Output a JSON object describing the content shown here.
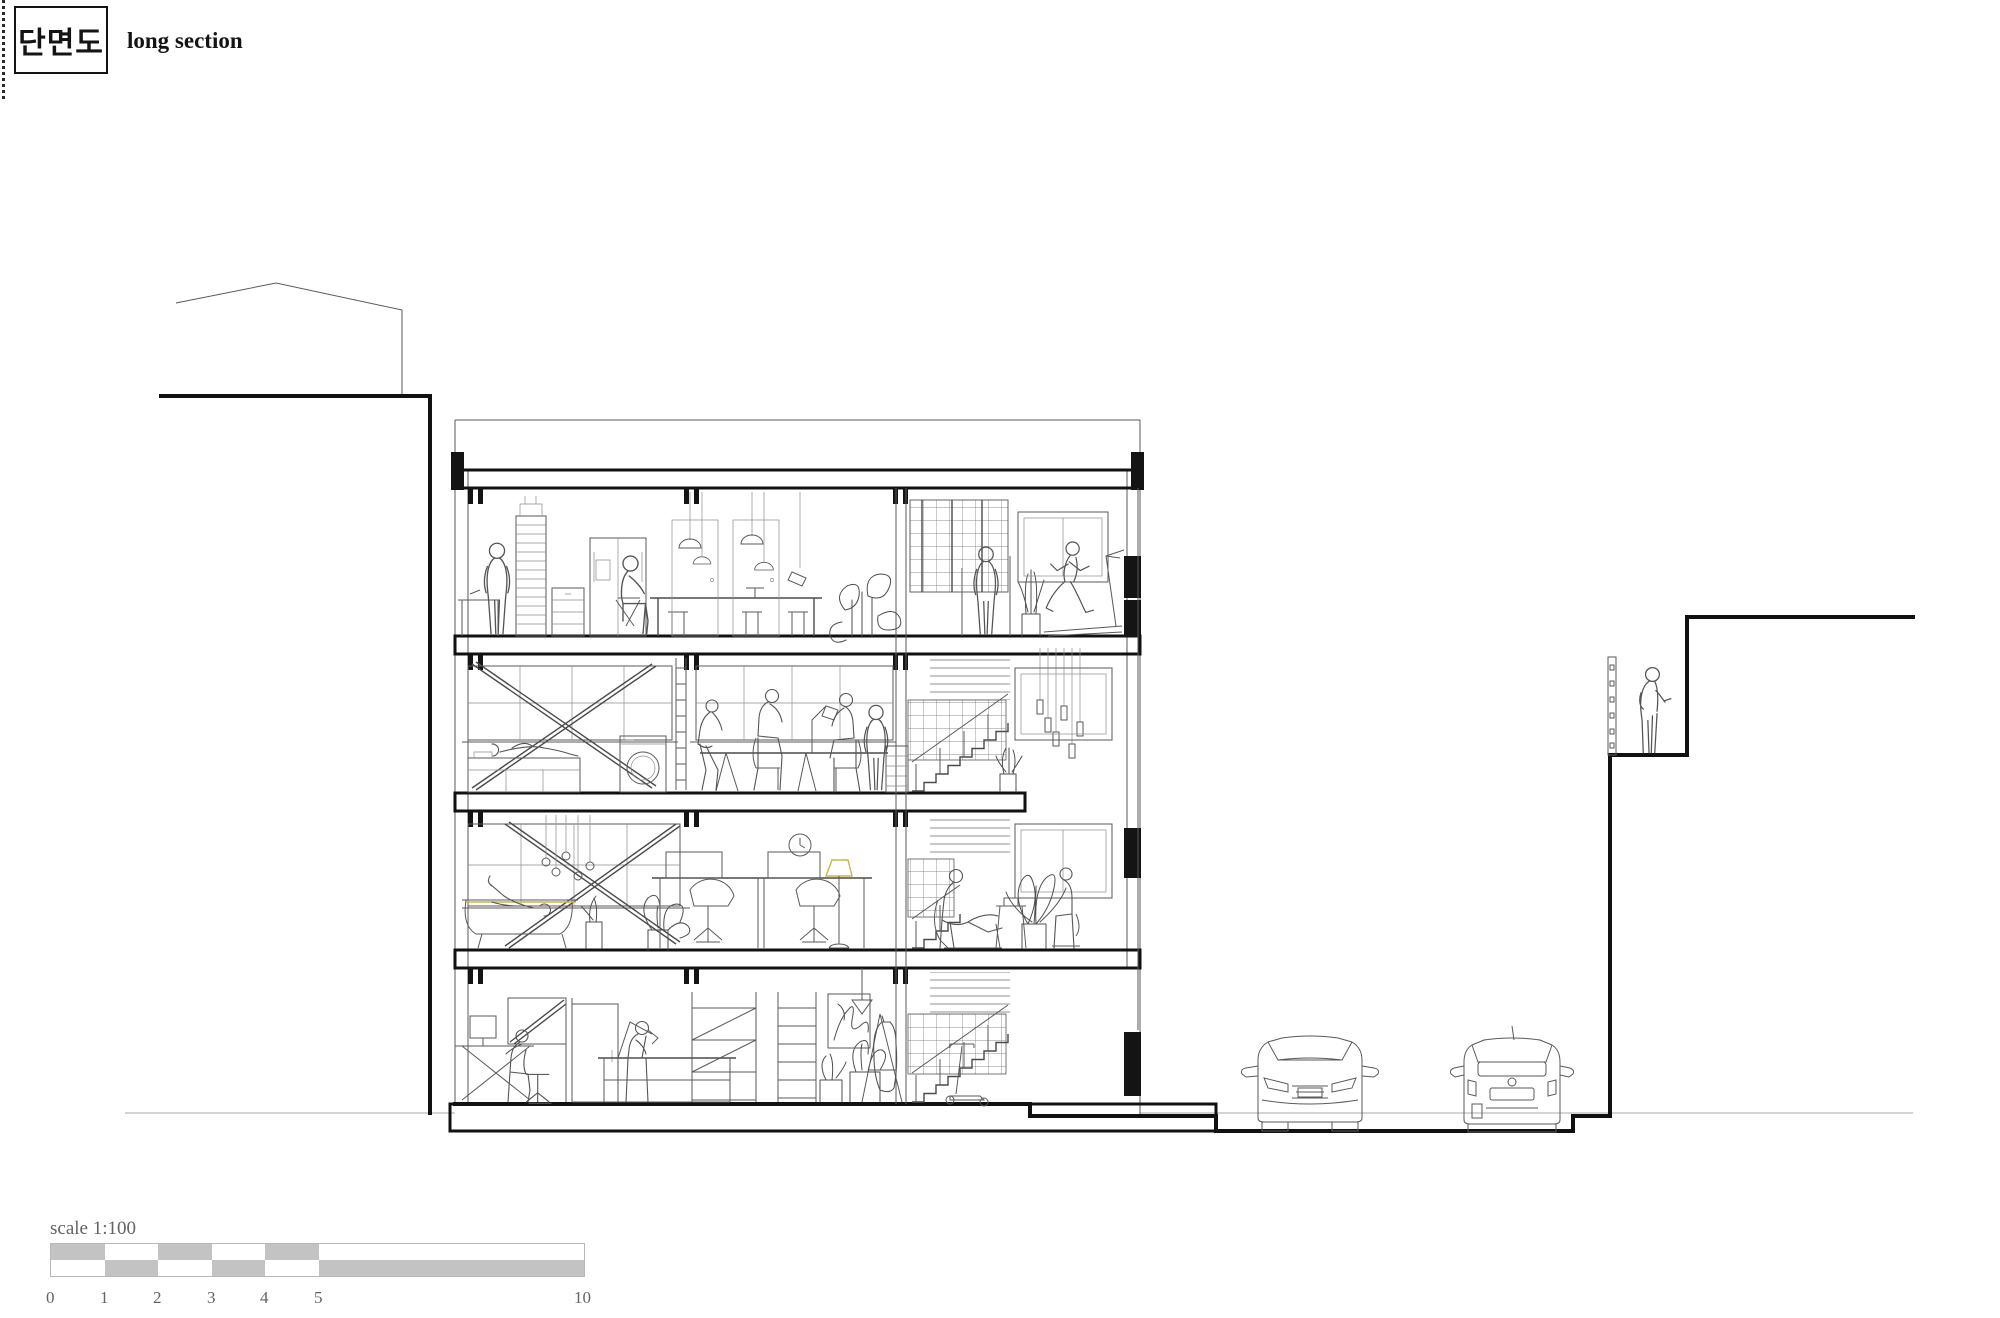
{
  "title_block": {
    "korean_title": "단면도",
    "english_title": "long section"
  },
  "scale_bar": {
    "label": "scale 1:100",
    "ticks": [
      "0",
      "1",
      "2",
      "3",
      "4",
      "5",
      "10"
    ],
    "bar_fill": "#c3c3c3"
  },
  "colors": {
    "paper": "#ffffff",
    "section_cut_ink": "#111111",
    "drawing_ink": "#4a4a4a",
    "light_ink": "#8d8d8d",
    "text_gray": "#636363",
    "accent_yellow": "#c9b64b"
  },
  "scene": {
    "type": "architectural-long-section",
    "storeys": 4,
    "objects": [
      "neighbor-building-roofline",
      "site-ground-line",
      "four-storey-building-section",
      "kitchen-dining-floor",
      "gym-treadmill",
      "bedroom-laundry-floor",
      "meeting-table-group",
      "bath-workspace-floor",
      "ground-floor-studio",
      "stairwell",
      "pendant-lights",
      "street-with-two-cars",
      "retaining-wall-terraces",
      "person-on-terrace",
      "scale-bar"
    ]
  }
}
